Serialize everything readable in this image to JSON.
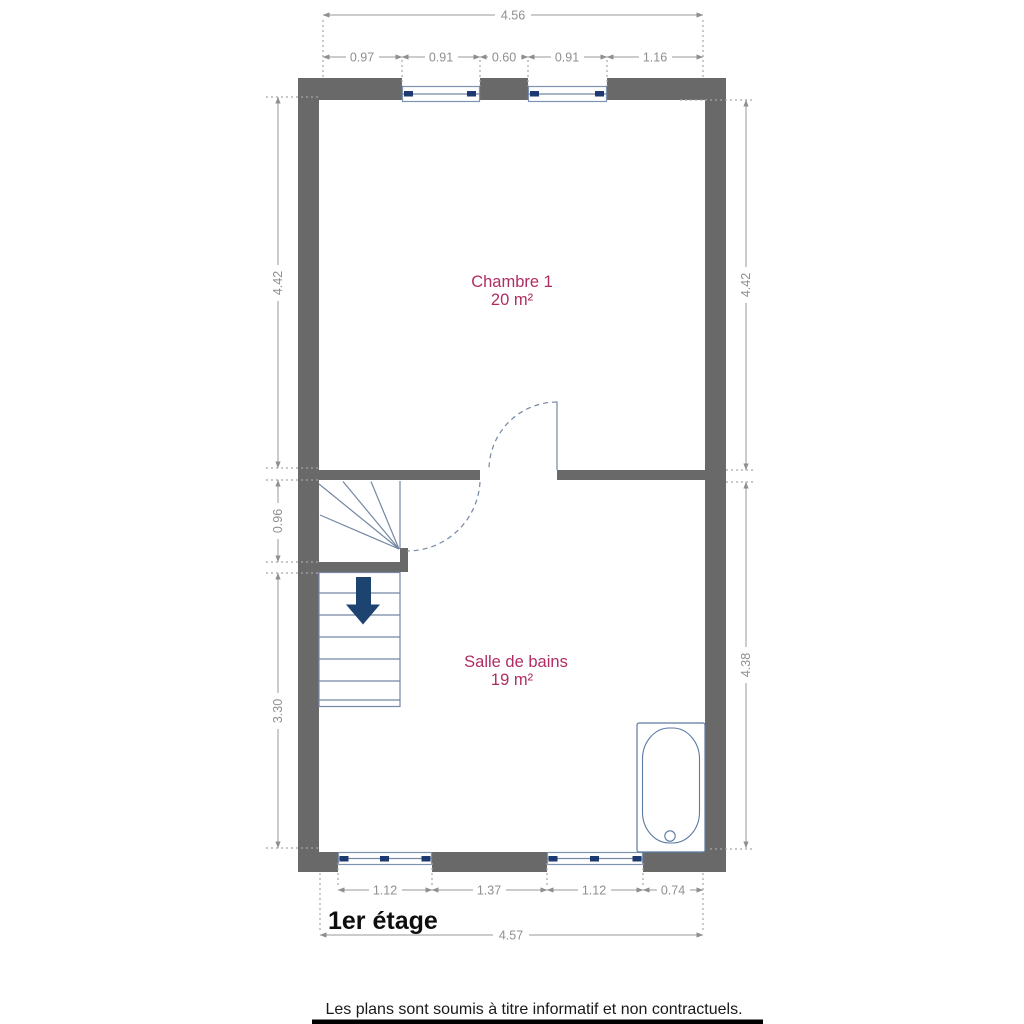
{
  "floor_plan": {
    "title": "1er étage",
    "disclaimer": "Les plans sont soumis à titre informatif et non contractuels.",
    "rooms": [
      {
        "name": "Chambre 1",
        "area": "20 m²"
      },
      {
        "name": "Salle de bains",
        "area": "19 m²"
      }
    ],
    "dimensions": {
      "top_total": "4.56",
      "top_segments": [
        "0.97",
        "0.91",
        "0.60",
        "0.91",
        "1.16"
      ],
      "left_top": "4.42",
      "left_middle": "0.96",
      "left_bottom": "3.30",
      "right_top": "4.42",
      "right_bottom": "4.38",
      "bottom_segments": [
        "1.12",
        "1.37",
        "1.12",
        "0.74"
      ],
      "bottom_total": "4.57"
    },
    "icons": {
      "stairs_direction": "down-arrow"
    },
    "colors": {
      "wall": "#696969",
      "dimension": "#8f8f8f",
      "room_label": "#b02d63",
      "fixture_line": "#7487a3",
      "window_dark": "#1d3a70",
      "stairs_arrow": "#1d4370"
    }
  }
}
